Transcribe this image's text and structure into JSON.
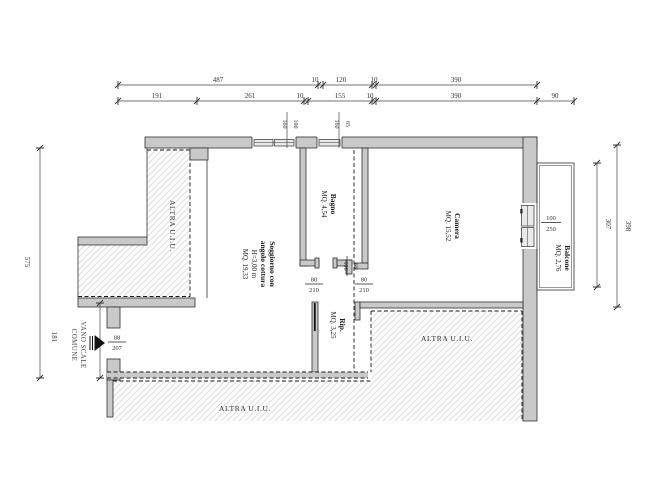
{
  "colors": {
    "wall_fill": "#c9c9c9",
    "wall_stroke": "#2f2f2f",
    "hatch_line": "#dedede",
    "dim_color": "#333333",
    "text_color": "#1a1a1a",
    "dashed_color": "#1a1a1a",
    "pane_fill": "#e9e9e9",
    "background": "#ffffff"
  },
  "dims": {
    "top1": [
      "487",
      "10",
      "120",
      "10",
      "390"
    ],
    "top2": [
      "191",
      "261",
      "10",
      "155",
      "10",
      "390"
    ],
    "top2_right": "90",
    "left": [
      "575",
      "181"
    ],
    "right": [
      "307",
      "398"
    ]
  },
  "openings": {
    "window1": {
      "width": "100",
      "height": "160"
    },
    "window2": {
      "width": "65",
      "height": "160"
    },
    "bagno_door": {
      "width": "65",
      "height": "196"
    },
    "rip_door": {
      "width": "80",
      "height": "210"
    },
    "camera_door": {
      "width": "80",
      "height": "210"
    },
    "entry_door": {
      "width": "88",
      "height": "207"
    },
    "balcony_door": {
      "width": "100",
      "height": "250"
    }
  },
  "rooms": {
    "soggiorno": {
      "name1": "Soggiorno con",
      "name2": "angolo cottura",
      "height": "H=3,00 m",
      "area": "MQ. 19,33"
    },
    "bagno": {
      "name": "Bagno",
      "area": "MQ. 4,54"
    },
    "camera": {
      "name": "Camera",
      "area": "MQ. 15,52"
    },
    "rip": {
      "name": "Rip.",
      "area": "MQ. 3,25"
    },
    "balcone": {
      "name": "Balcone",
      "area": "MQ. 2,76"
    },
    "vano_scale": {
      "name1": "VANO SCALE",
      "name2": "COMUNE"
    }
  },
  "adjacent": {
    "top_left": "ALTRA U.I.U.",
    "right": "ALTRA U.I.U.",
    "bottom": "ALTRA U.I.U."
  }
}
